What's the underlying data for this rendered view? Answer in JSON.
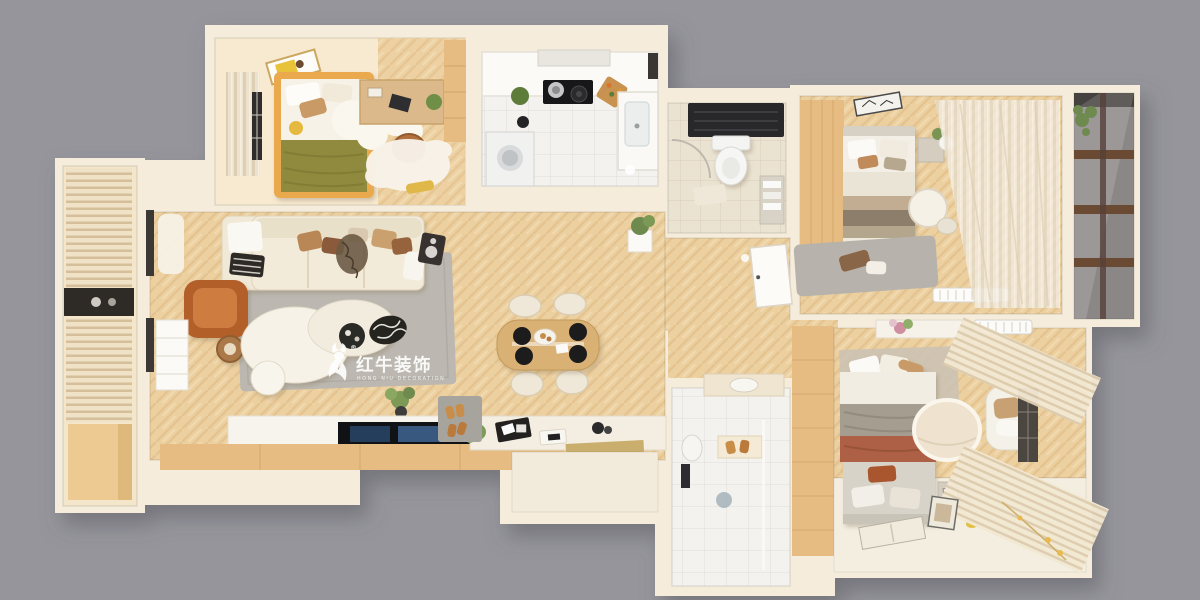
{
  "watermark": {
    "icon": "red-bull-logo-icon",
    "registered": "®",
    "title": "红牛装饰",
    "subtitle": "HONG NIU DECORATION"
  },
  "colors": {
    "background": "#95959b",
    "wall": "#f5ecdb",
    "wood_floor": "#ecd0a0",
    "wood_cabinet": "#e6bc82",
    "tile": "#f3f2ef",
    "tile_beige": "#ebe3d2",
    "rug": "#bcb8b1",
    "sofa": "#f2ebd9",
    "accent_rust": "#b35f2c",
    "accent_olive": "#8f8a3e",
    "blanket_rust": "#ad6144",
    "watermark": "#ffffff"
  }
}
